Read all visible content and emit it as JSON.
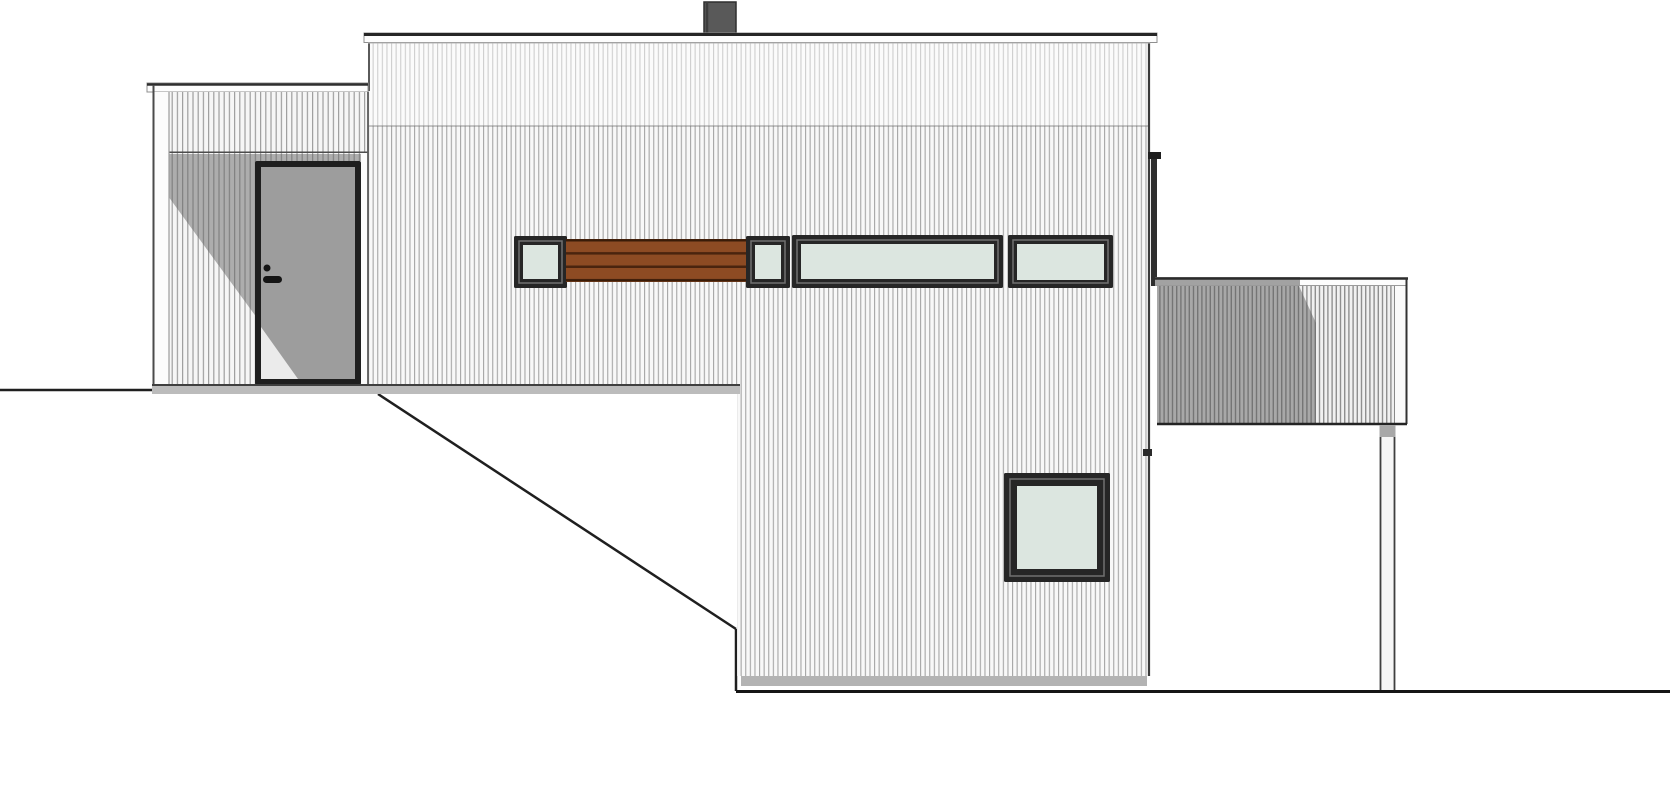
{
  "meta": {
    "drawing_type": "architectural-side-elevation",
    "canvas_width": 1670,
    "canvas_height": 800,
    "background": "#ffffff"
  },
  "colors": {
    "siding_base": "#f8f8f8",
    "siding_line": "#a6a6a6",
    "fascia_white": "#fdfdfd",
    "outline_dark": "#262626",
    "window_frame": "#262626",
    "glass": "#dce6e0",
    "wood_panel": "#8d4b23",
    "wood_gap": "#4a240e",
    "door_panel": "#9d9d9d",
    "porch_shadow": "rgba(100,100,100,0.5)",
    "deck_shadow": "rgba(90,90,90,0.48)",
    "chimney": "#595959",
    "floor_band": "#bcbcbc",
    "foundation": "#b3b3b3",
    "ground_line": "#1f1f1f"
  },
  "components": [
    "sloping-terrain-line",
    "chimney",
    "main-two-storey-volume",
    "roof-fascia",
    "clerestory-window-band",
    "wood-slat-panel",
    "lower-level-square-window",
    "left-entrance-porch",
    "entry-door",
    "right-deck-with-railing",
    "deck-post"
  ],
  "shapes": [
    {
      "n": "ground-line-left",
      "k": "line",
      "x1": 0,
      "y1": 390,
      "x2": 152,
      "y2": 390,
      "s": "#1f1f1f",
      "sw": 2.5
    },
    {
      "n": "terrain-diagonal-line",
      "k": "line",
      "x1": 378,
      "y1": 394,
      "x2": 736,
      "y2": 629,
      "s": "#1f1f1f",
      "sw": 2.5
    },
    {
      "n": "terrain-vertical-edge",
      "k": "line",
      "x1": 736,
      "y1": 629,
      "x2": 736,
      "y2": 691,
      "s": "#1f1f1f",
      "sw": 2.5
    },
    {
      "n": "chimney",
      "k": "rect",
      "x": 704,
      "y": 2,
      "w": 32,
      "h": 33,
      "f": "#595959",
      "s": "#2f2f2f",
      "sw": 1.5
    },
    {
      "n": "chimney-edge-line",
      "k": "line",
      "x1": 707,
      "y1": 2,
      "x2": 707,
      "y2": 35,
      "s": "#3d3d3d",
      "sw": 2.5
    },
    {
      "n": "main-wall-siding",
      "k": "polygon",
      "pts": "368,42 1150,42 1150,676 737,676 737,385 368,385",
      "f": "url(#pat-siding-main)"
    },
    {
      "n": "main-wall-upper-highlight",
      "k": "rect",
      "x": 368,
      "y": 42,
      "w": 782,
      "h": 84,
      "f": "rgba(255,255,255,0.45)"
    },
    {
      "n": "main-wall-joint-line",
      "k": "line",
      "x1": 368,
      "y1": 126,
      "x2": 1150,
      "y2": 126,
      "s": "rgba(110,110,110,0.6)",
      "sw": 1.2
    },
    {
      "n": "main-wall-left-edge",
      "k": "line",
      "x1": 369,
      "y1": 42,
      "x2": 369,
      "y2": 91,
      "s": "#5a5a5a",
      "sw": 2
    },
    {
      "n": "main-wall-right-edge",
      "k": "line",
      "x1": 1149,
      "y1": 42,
      "x2": 1149,
      "y2": 676,
      "s": "#3a3a3a",
      "sw": 2.2
    },
    {
      "n": "foundation-shadow-strip",
      "k": "rect",
      "x": 741,
      "y": 676,
      "w": 406,
      "h": 10,
      "f": "#b3b3b3"
    },
    {
      "n": "roof-fascia",
      "k": "rect",
      "x": 364,
      "y": 33,
      "w": 793,
      "h": 9.5,
      "f": "#fdfdfd",
      "s": "#8f8f8f",
      "sw": 1
    },
    {
      "n": "roof-fascia-top-line",
      "k": "line",
      "x1": 364,
      "y1": 34.5,
      "x2": 1157,
      "y2": 34.5,
      "s": "#262626",
      "sw": 3
    },
    {
      "n": "roof-fascia-shadow-line",
      "k": "line",
      "x1": 368,
      "y1": 43,
      "x2": 1150,
      "y2": 43,
      "s": "#b5b5b5",
      "sw": 1
    },
    {
      "n": "window-small-1-frame",
      "k": "rect",
      "x": 514,
      "y": 236,
      "w": 53,
      "h": 52,
      "f": "#262626",
      "rx": 1.5
    },
    {
      "n": "window-small-1-inner",
      "k": "rect",
      "x": 519,
      "y": 241,
      "w": 43,
      "h": 42,
      "f": "none",
      "s": "#707070",
      "sw": 1.5
    },
    {
      "n": "window-small-1-glass",
      "k": "rect",
      "x": 523,
      "y": 245,
      "w": 35,
      "h": 34,
      "f": "#dce6e0"
    },
    {
      "n": "wood-slat-panel",
      "k": "rect",
      "x": 566,
      "y": 239,
      "w": 180,
      "h": 43,
      "f": "url(#pat-boards)"
    },
    {
      "n": "wood-panel-top-line",
      "k": "line",
      "x1": 566,
      "y1": 240.5,
      "x2": 746,
      "y2": 240.5,
      "s": "#3a1c08",
      "sw": 2
    },
    {
      "n": "wood-panel-bottom-line",
      "k": "line",
      "x1": 566,
      "y1": 280.5,
      "x2": 746,
      "y2": 280.5,
      "s": "#3a1c08",
      "sw": 2
    },
    {
      "n": "window-small-2-frame",
      "k": "rect",
      "x": 746,
      "y": 236,
      "w": 44,
      "h": 52,
      "f": "#262626",
      "rx": 1.5
    },
    {
      "n": "window-small-2-inner",
      "k": "rect",
      "x": 751,
      "y": 241,
      "w": 34,
      "h": 42,
      "f": "none",
      "s": "#707070",
      "sw": 1.5
    },
    {
      "n": "window-small-2-glass",
      "k": "rect",
      "x": 755,
      "y": 245,
      "w": 26,
      "h": 34,
      "f": "#dce6e0"
    },
    {
      "n": "window-wide-3-frame",
      "k": "rect",
      "x": 792,
      "y": 235,
      "w": 211,
      "h": 53,
      "f": "#262626",
      "rx": 1.5
    },
    {
      "n": "window-wide-3-inner",
      "k": "rect",
      "x": 797,
      "y": 240,
      "w": 201,
      "h": 43,
      "f": "none",
      "s": "#707070",
      "sw": 1.5
    },
    {
      "n": "window-wide-3-glass",
      "k": "rect",
      "x": 801,
      "y": 244,
      "w": 193,
      "h": 35,
      "f": "#dce6e0"
    },
    {
      "n": "window-wide-4-frame",
      "k": "rect",
      "x": 1008,
      "y": 235,
      "w": 105,
      "h": 53,
      "f": "#262626",
      "rx": 1.5
    },
    {
      "n": "window-wide-4-inner",
      "k": "rect",
      "x": 1013,
      "y": 240,
      "w": 95,
      "h": 43,
      "f": "none",
      "s": "#707070",
      "sw": 1.5
    },
    {
      "n": "window-wide-4-glass",
      "k": "rect",
      "x": 1017,
      "y": 244,
      "w": 87,
      "h": 36,
      "f": "#dce6e0"
    },
    {
      "n": "window-square-lower-frame",
      "k": "rect",
      "x": 1004,
      "y": 473,
      "w": 106,
      "h": 109,
      "f": "#262626",
      "rx": 1.5
    },
    {
      "n": "window-square-lower-inner",
      "k": "rect",
      "x": 1010,
      "y": 479,
      "w": 94,
      "h": 97,
      "f": "none",
      "s": "#707070",
      "sw": 1.5
    },
    {
      "n": "window-square-lower-glass",
      "k": "rect",
      "x": 1017,
      "y": 486,
      "w": 80,
      "h": 83,
      "f": "#dce6e0"
    },
    {
      "n": "downspout",
      "k": "rect",
      "x": 1151,
      "y": 156,
      "w": 6,
      "h": 130,
      "f": "#2e2e2e"
    },
    {
      "n": "gutter-bracket-upper",
      "k": "rect",
      "x": 1148,
      "y": 152,
      "w": 13,
      "h": 7,
      "f": "#1e1e1e"
    },
    {
      "n": "gutter-bracket-lower",
      "k": "rect",
      "x": 1143,
      "y": 449,
      "w": 9,
      "h": 7,
      "f": "#2a2a2a"
    },
    {
      "n": "porch-cap",
      "k": "rect",
      "x": 147,
      "y": 83,
      "w": 221,
      "h": 9,
      "f": "#fdfdfd",
      "s": "#8f8f8f",
      "sw": 1
    },
    {
      "n": "porch-cap-top-line",
      "k": "line",
      "x1": 147,
      "y1": 84.5,
      "x2": 368,
      "y2": 84.5,
      "s": "#2e2e2e",
      "sw": 2.5
    },
    {
      "n": "porch-upper-band-siding",
      "k": "rect",
      "x": 153,
      "y": 92,
      "w": 215,
      "h": 61,
      "f": "url(#pat-siding-porch)"
    },
    {
      "n": "porch-soffit-line",
      "k": "line",
      "x1": 153,
      "y1": 152.5,
      "x2": 368,
      "y2": 152.5,
      "s": "#4c4c4c",
      "sw": 2
    },
    {
      "n": "porch-recess-siding",
      "k": "rect",
      "x": 168,
      "y": 153,
      "w": 195,
      "h": 232,
      "f": "url(#pat-siding-porch)"
    },
    {
      "n": "porch-shadow",
      "k": "polygon",
      "pts": "168,154 363,154 363,161 257,161 257,318 168,196",
      "f": "rgba(100,100,100,0.5)"
    },
    {
      "n": "porch-corner-board",
      "k": "rect",
      "x": 153,
      "y": 92,
      "w": 16,
      "h": 293,
      "f": "#fcfcfc"
    },
    {
      "n": "porch-corner-board-edge",
      "k": "line",
      "x1": 169,
      "y1": 92,
      "x2": 169,
      "y2": 385,
      "s": "#9b9b9b",
      "sw": 1.2
    },
    {
      "n": "porch-left-edge",
      "k": "line",
      "x1": 153.5,
      "y1": 85,
      "x2": 153.5,
      "y2": 385,
      "s": "#4a4a4a",
      "sw": 2
    },
    {
      "n": "porch-right-side-strip",
      "k": "rect",
      "x": 361,
      "y": 153,
      "w": 7,
      "h": 232,
      "f": "#fbfbfb"
    },
    {
      "n": "main-wall-corner-line",
      "k": "line",
      "x1": 368,
      "y1": 92,
      "x2": 368,
      "y2": 385,
      "s": "#5a5a5a",
      "sw": 1.8
    },
    {
      "n": "entry-door-frame",
      "k": "rect",
      "x": 255,
      "y": 161,
      "w": 106,
      "h": 224,
      "f": "#1f1f1f",
      "rx": 2
    },
    {
      "n": "entry-door-panel",
      "k": "rect",
      "x": 261,
      "y": 167,
      "w": 94,
      "h": 212,
      "f": "#9d9d9d"
    },
    {
      "n": "entry-door-light-triangle",
      "k": "polygon",
      "pts": "261,327 261,379 298,379",
      "f": "rgba(255,255,255,0.8)"
    },
    {
      "n": "door-lock-cylinder",
      "k": "circle",
      "cx": 267,
      "cy": 268,
      "r": 3.5,
      "f": "#151515"
    },
    {
      "n": "door-handle",
      "k": "rect",
      "x": 263,
      "y": 276,
      "w": 19,
      "h": 7,
      "f": "#151515",
      "rx": 3.5
    },
    {
      "n": "floor-band",
      "k": "rect",
      "x": 152,
      "y": 384,
      "w": 588,
      "h": 10,
      "f": "#bcbcbc"
    },
    {
      "n": "floor-band-top-line",
      "k": "line",
      "x1": 152,
      "y1": 385,
      "x2": 740,
      "y2": 385,
      "s": "#3f3f3f",
      "sw": 2
    },
    {
      "n": "deck-cap",
      "k": "rect",
      "x": 1155,
      "y": 277,
      "w": 253,
      "h": 8.5,
      "f": "#fcfcfc"
    },
    {
      "n": "deck-cap-shadow",
      "k": "rect",
      "x": 1155,
      "y": 277,
      "w": 145,
      "h": 8.5,
      "f": "#a2a2a2"
    },
    {
      "n": "deck-cap-top-line",
      "k": "line",
      "x1": 1155,
      "y1": 278.5,
      "x2": 1408,
      "y2": 278.5,
      "s": "#2b2b2b",
      "sw": 2.5
    },
    {
      "n": "deck-cap-bottom-line",
      "k": "line",
      "x1": 1155,
      "y1": 285.5,
      "x2": 1407,
      "y2": 285.5,
      "s": "#9a9a9a",
      "sw": 1
    },
    {
      "n": "deck-railing-slats",
      "k": "rect",
      "x": 1157,
      "y": 286,
      "w": 237,
      "h": 138,
      "f": "url(#pat-slats)"
    },
    {
      "n": "deck-railing-shadow",
      "k": "polygon",
      "pts": "1157,286 1299,286 1316,323 1316,423 1157,423",
      "f": "rgba(90,90,90,0.48)"
    },
    {
      "n": "deck-right-fascia",
      "k": "rect",
      "x": 1394,
      "y": 286,
      "w": 13,
      "h": 138,
      "f": "#fbfbfb"
    },
    {
      "n": "deck-right-fascia-line",
      "k": "line",
      "x1": 1394.5,
      "y1": 286,
      "x2": 1394.5,
      "y2": 423,
      "s": "#8a8a8a",
      "sw": 1
    },
    {
      "n": "deck-right-edge",
      "k": "line",
      "x1": 1406.5,
      "y1": 278,
      "x2": 1406.5,
      "y2": 424,
      "s": "#333333",
      "sw": 2
    },
    {
      "n": "deck-bottom-line",
      "k": "line",
      "x1": 1157,
      "y1": 424,
      "x2": 1407,
      "y2": 424,
      "s": "#242424",
      "sw": 2.5
    },
    {
      "n": "deck-post",
      "k": "rect",
      "x": 1379.5,
      "y": 425,
      "w": 16,
      "h": 266,
      "f": "#f6f6f6"
    },
    {
      "n": "deck-post-left-line",
      "k": "line",
      "x1": 1380.5,
      "y1": 425,
      "x2": 1380.5,
      "y2": 691,
      "s": "#3f3f3f",
      "sw": 1.8
    },
    {
      "n": "deck-post-right-line",
      "k": "line",
      "x1": 1394.5,
      "y1": 425,
      "x2": 1394.5,
      "y2": 691,
      "s": "#3f3f3f",
      "sw": 1.8
    },
    {
      "n": "deck-post-top-shadow",
      "k": "rect",
      "x": 1379.5,
      "y": 425,
      "w": 16,
      "h": 12,
      "f": "#a8a8a8"
    },
    {
      "n": "ground-line-right",
      "k": "line",
      "x1": 736,
      "y1": 691.5,
      "x2": 1670,
      "y2": 691.5,
      "s": "#151515",
      "sw": 3
    }
  ]
}
